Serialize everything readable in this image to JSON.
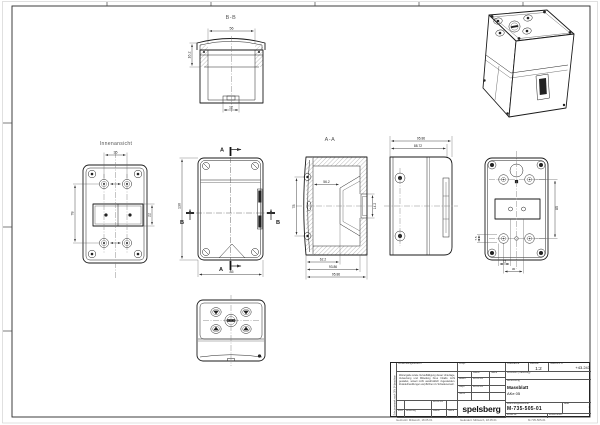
{
  "labels": {
    "section_bb": "B-B",
    "section_aa": "A-A",
    "inner_view": "Innenansicht",
    "cut_a": "A",
    "cut_b": "B"
  },
  "dimensions": {
    "bb": {
      "top": "56",
      "left": "16.2",
      "bottom": "12"
    },
    "inner": {
      "top": "35",
      "left": "78",
      "right": "22"
    },
    "front": {
      "left": "130",
      "bottom": "85"
    },
    "aa": {
      "left": "78",
      "inner_width": "56.2",
      "inner_height": "14.2",
      "bottom1": "62.2",
      "bottom2": "93.86",
      "bottom3": "95.86"
    },
    "side": {
      "top1": "95.86",
      "top2": "88.72"
    },
    "back": {
      "right": "85",
      "left": "7.5",
      "bottom1": "12",
      "bottom2": "30"
    }
  },
  "titleblock": {
    "schutzvermerk": "Schutzvermerk nach DIN 34 beachten",
    "verwendungsbereich": "Verwendungsbereich",
    "disclaimer": "Weitergabe sowie Vervielfältigung dieser Unterlage, Verwertung und Mitteilung ihres Inhalts nicht gestattet, soweit nicht ausdrücklich zugestanden. Zuwiderhandlungen verpflichten zu Schadenersatz.",
    "urspr": "Urspr.",
    "datum_label": "Datum",
    "name_label": "Name",
    "bearb_label": "Bearb.",
    "gepr_label": "Gepr.",
    "norm_label": "Norm",
    "bearb_datum": "18.05.01",
    "gepr_datum": "18.05.01",
    "zust_label": "Zust.",
    "aenderung_label": "Änderung",
    "rev_datum": "18.05.01",
    "oberflaeche_label": "Oberfläche",
    "massstab_label": "Maßstab",
    "massstab": "1:2",
    "gewicht_label": "Gewicht in G",
    "gewicht": "+43.243",
    "werkstoff_label": "Werkstoff (Halbzeug)",
    "benennung_label": "Benennung",
    "benennung": "Massblatt",
    "benennung2": "AKe 05",
    "logo": "spelsberg",
    "zeichnungsnummer_label": "Zeichnungsnummer",
    "zeichnungsnummer": "M-735-505-01",
    "blatt_label": "Blatt",
    "blatt": "1",
    "ersatz_fuer": "Ersatz für:",
    "ersetzt_durch": "Ersetzt durch:"
  },
  "footer": {
    "left": "Gedruckt: Mittwoch, 18.05.01",
    "mid": "Geändert: Mittwoch, 18.05.01",
    "right": "M-735-505-01"
  },
  "colors": {
    "line": "#1a1a1a",
    "dim": "#333333",
    "paper": "#ffffff"
  }
}
